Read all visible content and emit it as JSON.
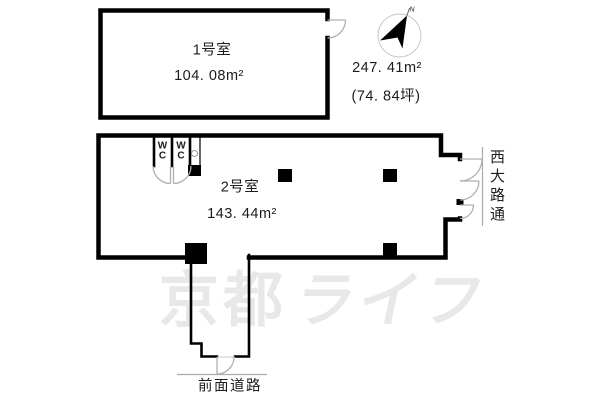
{
  "rooms": {
    "room1": {
      "label": "1号室",
      "area": "104. 08m²"
    },
    "room2": {
      "label": "2号室",
      "area": "143. 44m²"
    },
    "wc_label": "W\nC"
  },
  "summary": {
    "total_area": "247. 41m²",
    "total_tsubo": "(74. 84坪)"
  },
  "roads": {
    "right_name": "西大路通",
    "bottom_name": "前面道路"
  },
  "compass": {
    "north_label": "N"
  },
  "watermark": {
    "kanji": "京都",
    "kana": "ライフ"
  },
  "colors": {
    "wall": "#000000",
    "door": "#b0b0b0",
    "road": "#ababab",
    "watermark": "#e8e8ea",
    "text": "#1c1c1c",
    "bg": "#ffffff"
  }
}
